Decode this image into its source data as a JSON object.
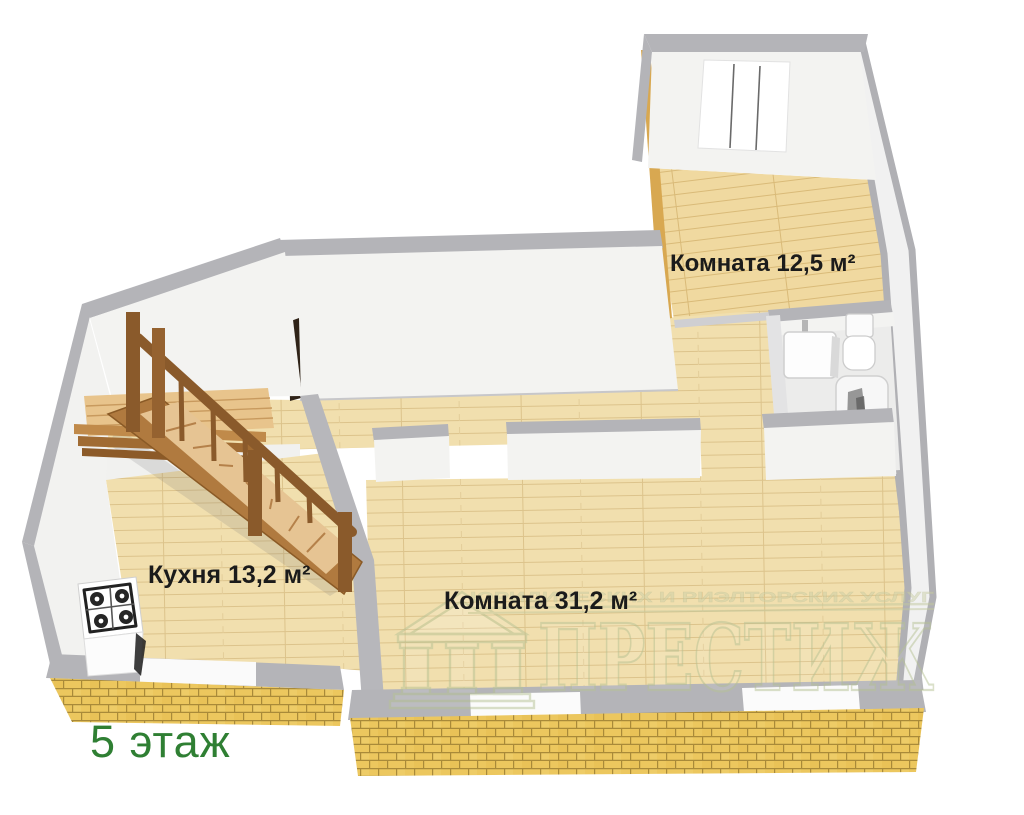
{
  "plan": {
    "floor_label": "5 этаж",
    "rooms": [
      {
        "id": "room-12-5",
        "label": "Комната 12,5 м²"
      },
      {
        "id": "kitchen",
        "label": "Кухня 13,2 м²"
      },
      {
        "id": "room-31-2",
        "label": "Комната 31,2 м²"
      }
    ],
    "fixtures": [
      "staircase",
      "gas-stove",
      "sink",
      "toilet",
      "bathtub",
      "window"
    ],
    "colors": {
      "wall_gray": "#b4b4b8",
      "wall_white": "#f3f3f1",
      "floor_wood": "#f1dfae",
      "floor_wood_room": "#f0d9a0",
      "brick": "#ecc75e",
      "brick_mortar": "#a98a39",
      "stair_wood": "#8a5a2b",
      "label_text": "#1b1b1b",
      "floor_label_green": "#2f7f33",
      "watermark_green": "#b7c295"
    }
  },
  "watermark": {
    "title": "ПРЕСТИЖ",
    "tagline": "ЮРИДИЧЕСКИХ И РИЭЛТОРСКИХ УСЛУГ"
  }
}
